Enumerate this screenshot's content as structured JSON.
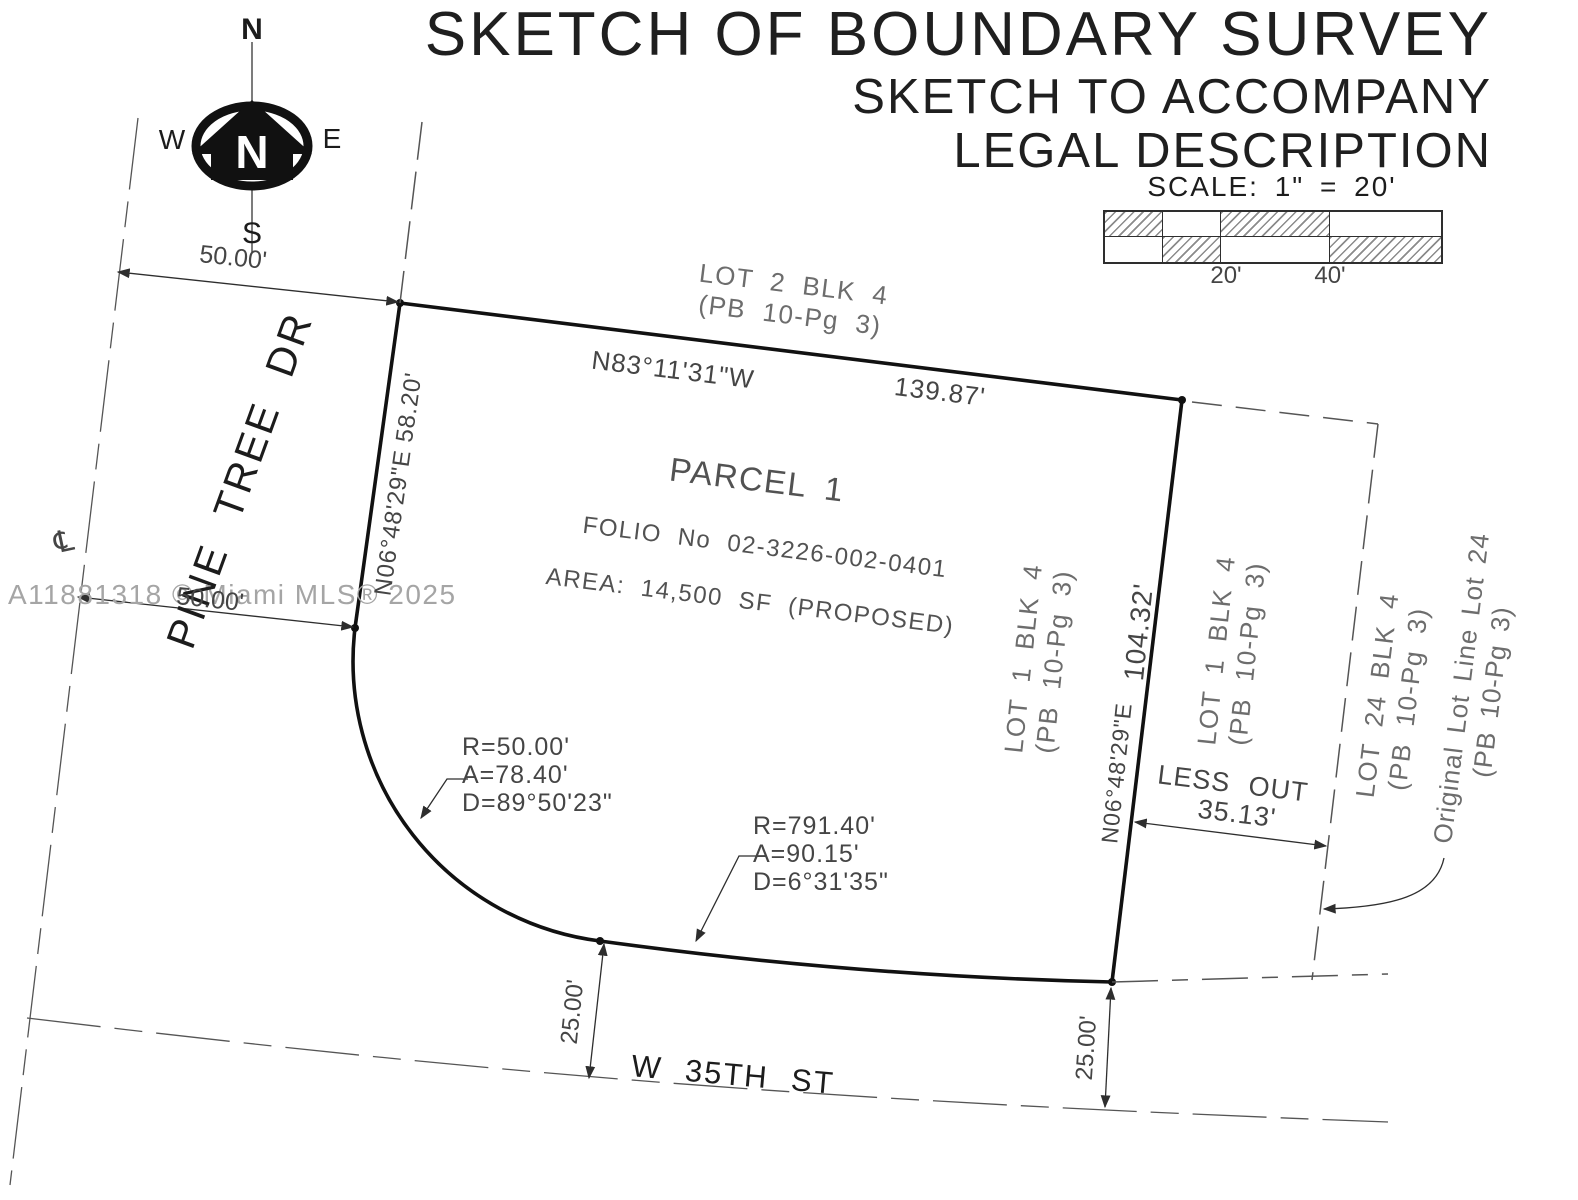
{
  "title": {
    "line1": "SKETCH OF BOUNDARY SURVEY",
    "line2": "SKETCH TO ACCOMPANY",
    "line3": "LEGAL DESCRIPTION"
  },
  "scale": {
    "label": "SCALE: 1\" = 20'",
    "tick20": "20'",
    "tick40": "40'"
  },
  "compass": {
    "north": "N",
    "south": "S",
    "east": "E",
    "west": "W",
    "center_letter": "N"
  },
  "watermark": {
    "text": "A11881318 © Miami MLS® 2025"
  },
  "streets": {
    "pine_tree_dr": "PINE TREE DR",
    "w_35th_st": "W 35TH ST",
    "centerline_symbol": "℄"
  },
  "parcel": {
    "name": "PARCEL 1",
    "folio": "FOLIO No 02-3226-002-0401",
    "area": "AREA: 14,500 SF (PROPOSED)"
  },
  "lots": {
    "lot2": {
      "line1": "LOT 2 BLK 4",
      "line2": "(PB 10-Pg 3)"
    },
    "lot1_west": {
      "line1": "LOT 1 BLK 4",
      "line2": "(PB 10-Pg 3)"
    },
    "lot1_east": {
      "line1": "LOT 1 BLK 4",
      "line2": "(PB 10-Pg 3)"
    },
    "lot24": {
      "line1": "LOT 24 BLK 4",
      "line2": "(PB 10-Pg 3)"
    },
    "original": {
      "line1": "Original Lot Line Lot 24",
      "line2": "(PB 10-Pg 3)"
    }
  },
  "bearings": {
    "north": {
      "bearing": "N83°11'31\"W",
      "distance": "139.87'"
    },
    "west": {
      "text": "N06°48'29\"E 58.20'"
    },
    "east": {
      "distance": "104.32'",
      "bearing": "N06°48'29\"E"
    }
  },
  "curves": {
    "c1": {
      "radius": "R=50.00'",
      "arc": "A=78.40'",
      "delta": "D=89°50'23\""
    },
    "c2": {
      "radius": "R=791.40'",
      "arc": "A=90.15'",
      "delta": "D=6°31'35\""
    }
  },
  "dims": {
    "top50": "50.00'",
    "bottom50": "50.00'",
    "left25": "25.00'",
    "right25": "25.00'",
    "lessout_label": "LESS OUT",
    "lessout_value": "35.13'"
  },
  "colors": {
    "boundary": "#111111",
    "thin_line": "#4a4a4a",
    "text_gray": "#6d6d6d",
    "watermark": "#a5a5a5"
  }
}
